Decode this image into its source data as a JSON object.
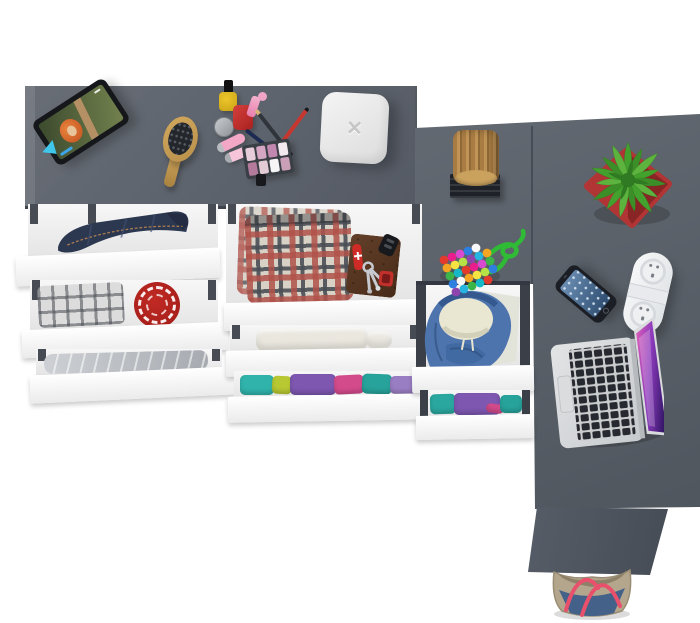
{
  "scene": {
    "description": "Top-down 3D render of an L-shaped gray desk and dresser with open white drawers of folded clothes and lifestyle objects arranged on top",
    "background": "#ffffff"
  },
  "colors": {
    "desk_top": "#5c626c",
    "desk_wing": "#596069",
    "side_panel": "#4e5560",
    "seam": "#474d57",
    "drawer_front": "#fbfbfb",
    "drawer_interior": "#e4e4e4",
    "drawer_rail": "#464b54",
    "jeans": "#2c3750",
    "red_shirt": "#ae201d",
    "hoodie": "#4e74ae",
    "hoodie_lining": "#e9e7d2",
    "tablet_frame": "#15171b",
    "brush_wood": "#c59a52",
    "box": "#e9eaeb",
    "stump_wood": "#b1854c",
    "stump_stand": "#1e2127",
    "plant_leaf": "#43a12d",
    "plant_pot": "#b23535",
    "bead_cord": "#2fbb35",
    "phone_body": "#1b1e25",
    "strip_body": "#f3f4f5",
    "laptop_body": "#d6d8da",
    "laptop_keys": "#26292f",
    "bag_canvas": "#b3a68c",
    "bag_denim": "#44618a",
    "bag_strap": "#e8506b"
  },
  "objects": {
    "tablet": {
      "label": "Tablet propped on a stand playing an animated movie"
    },
    "hairbrush": {
      "label": "Wooden oval hairbrush"
    },
    "makeup": {
      "label": "Makeup set: nail polishes, jar, lipstick, crossed pencils, lip gloss tubes, eyeshadow palette"
    },
    "white_box": {
      "label": "White rounded storage box",
      "glyph": "✕"
    },
    "stump": {
      "label": "Decorative wood stump on black stand"
    },
    "plant": {
      "label": "Green spiky plant in red pot"
    },
    "bead_pouch": {
      "label": "Multicolor bead pouch with green cord"
    },
    "phone": {
      "label": "Smartphone"
    },
    "power_strip": {
      "label": "White pill-shaped power strip"
    },
    "laptop": {
      "label": "Open laptop with magenta wallpaper"
    },
    "bag": {
      "label": "Canvas and denim tote bag with red straps"
    },
    "drawers": {
      "left": [
        "Folded blue jeans",
        "Gray plaid shirt and red patterned tee",
        "Gray folded sweatpants"
      ],
      "middle": [
        "Red plaid shorts with leather wallet, pocket knife, keys and fobs",
        "Cream folded towel",
        "Folded purple, teal and pink shirts"
      ],
      "right": [
        "Blue hoodie with cream lining",
        "Folded purple and teal shirts"
      ]
    }
  }
}
